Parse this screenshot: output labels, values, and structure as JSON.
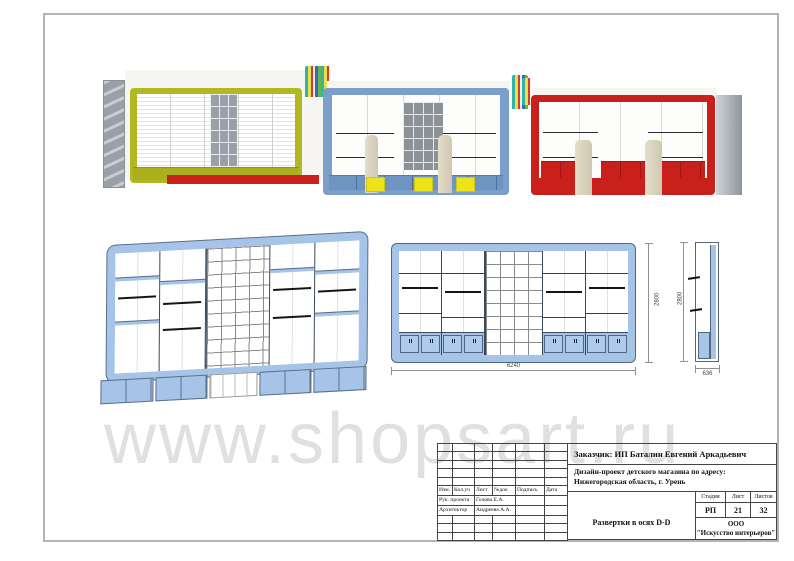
{
  "watermark": {
    "text": "www.shopsart.ru"
  },
  "colors": {
    "render_olive": "#b2b821",
    "render_blue": "#7c9fca",
    "render_red": "#c9201c",
    "drawing_blue": "#a6c4e8",
    "stool_yellow": "#eee318",
    "watermark_gray": "#d0d0d0"
  },
  "dimensions": {
    "elevation_width": "6240",
    "elevation_height": "2800",
    "side_height": "2800",
    "side_depth": "636"
  },
  "titleblock": {
    "customer": "Заказчик:  ИП Баталин Евгений Аркадьевич",
    "project_address_line1": "Дизайн-проект детского магазина по адресу:",
    "project_address_line2": "Нижегородская область, г. Урень",
    "sheet_title": "Развертки в осях D-D",
    "company_line1": "ООО",
    "company_line2": "\"Искусство интерьеров\"",
    "signature_table": {
      "header": [
        "Изм.",
        "Кол.уч",
        "Лист",
        "№док",
        "Подпись",
        "Дата"
      ],
      "rows": [
        {
          "role": "Рук. проекта",
          "name": "Голова Е.А."
        },
        {
          "role": "Архитектор",
          "name": "Андреева А.А."
        }
      ]
    },
    "stage_table": {
      "headers": [
        "Стадия",
        "Лист",
        "Листов"
      ],
      "values": [
        "РП",
        "21",
        "32"
      ]
    }
  }
}
